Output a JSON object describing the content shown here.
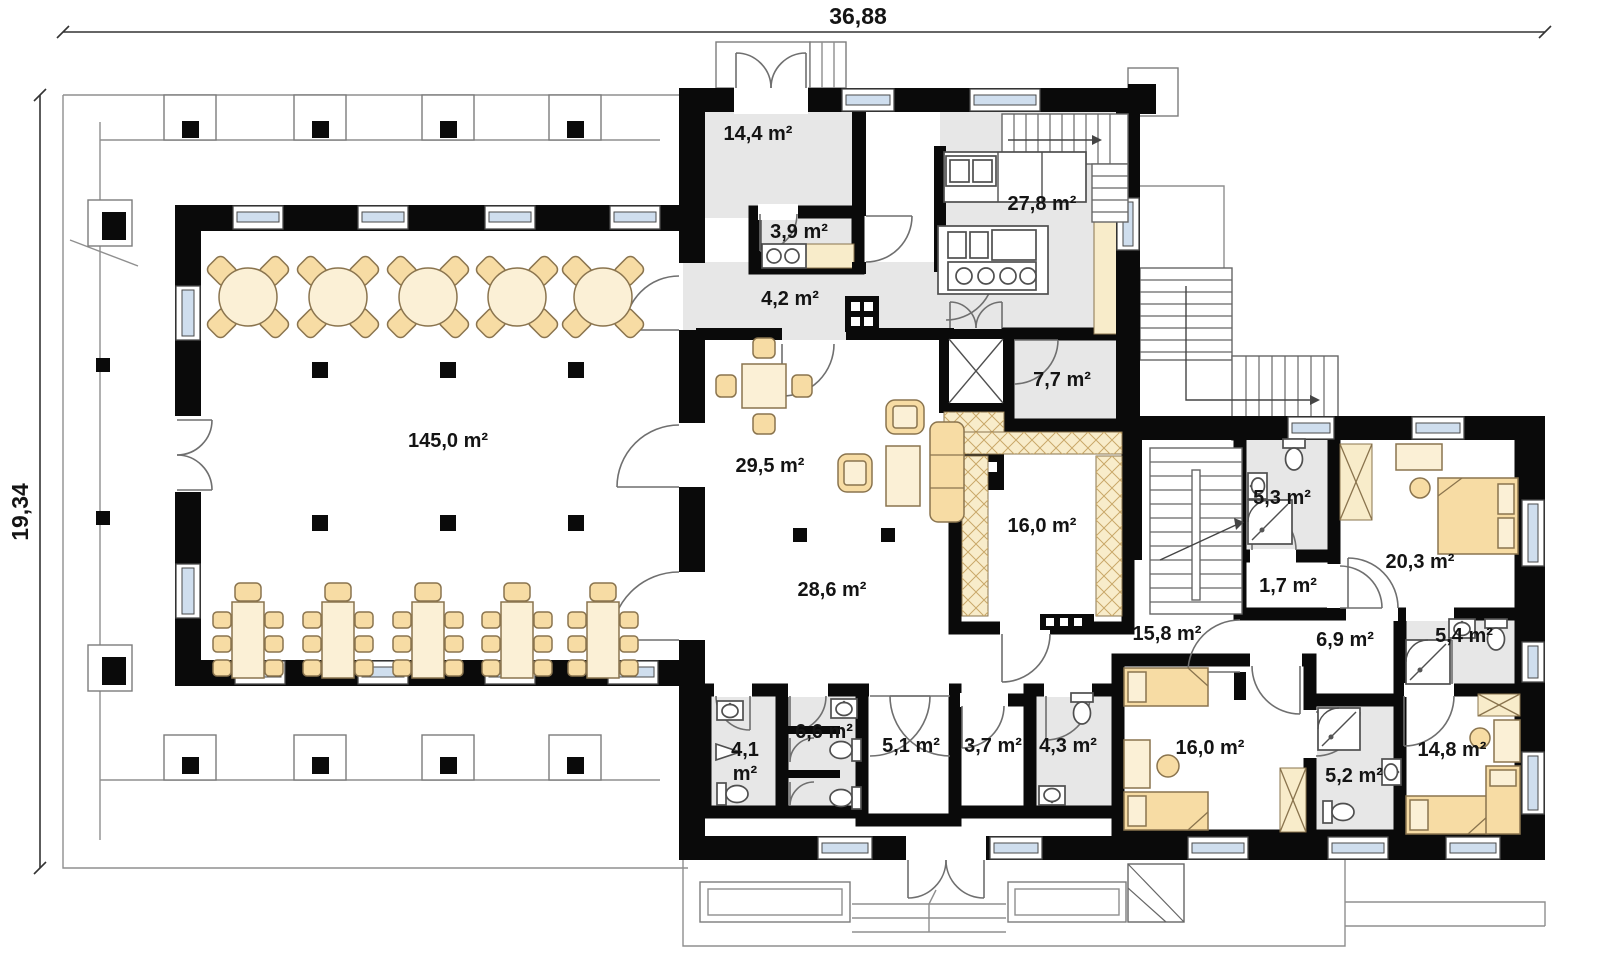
{
  "title": "Floor plan",
  "dimensions": {
    "width_label": "36,88",
    "height_label": "19,34"
  },
  "rooms": {
    "hall": {
      "label": "145,0 m²"
    },
    "vestibule": {
      "label": "14,4 m²"
    },
    "wc39": {
      "label": "3,9 m²"
    },
    "corridor42": {
      "label": "4,2 m²"
    },
    "kitchen": {
      "label": "27,8 m²"
    },
    "storage77": {
      "label": "7,7 m²"
    },
    "lounge": {
      "label": "29,5 m²"
    },
    "room16a": {
      "label": "16,0 m²"
    },
    "bath53": {
      "label": "5,3 m²"
    },
    "closet17": {
      "label": "1,7 m²"
    },
    "bedroom203": {
      "label": "20,3 m²"
    },
    "corridor286": {
      "label": "28,6 m²"
    },
    "hall158": {
      "label": "15,8 m²"
    },
    "hall69": {
      "label": "6,9 m²"
    },
    "bath54": {
      "label": "5,4 m²"
    },
    "wc41": {
      "line1": "4,1",
      "line2": "m²"
    },
    "wc66": {
      "label": "6,6 m²"
    },
    "storage51": {
      "label": "5,1 m²"
    },
    "storage37": {
      "label": "3,7 m²"
    },
    "bath43": {
      "label": "4,3 m²"
    },
    "bedroom16b": {
      "label": "16,0 m²"
    },
    "bath52": {
      "label": "5,2 m²"
    },
    "bedroom148": {
      "label": "14,8 m²"
    }
  },
  "colors": {
    "wall": "#0a0a0a",
    "room-gray": "#e7e7e7",
    "cream": "#f8ecca",
    "furn": "#f7dca4",
    "furn-light": "#fbf0d6",
    "furn-stroke": "#8a744e",
    "window": "#cfdeee",
    "line": "#8f8f8f",
    "door": "#6f6f6f",
    "text": "#141414",
    "bg": "#ffffff"
  }
}
